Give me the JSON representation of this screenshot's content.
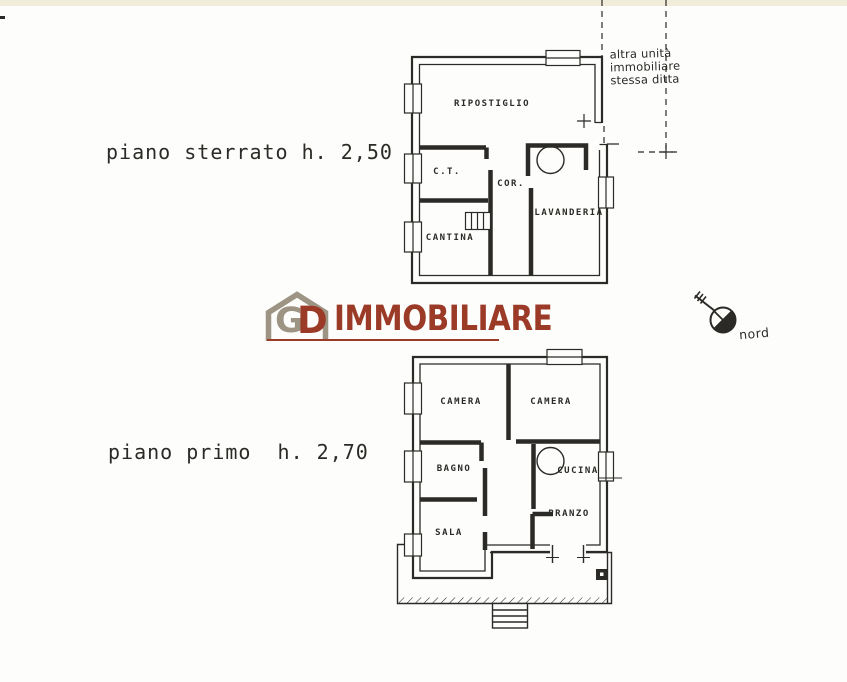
{
  "document": {
    "background": "#fdfdfc",
    "ink_color": "#2b2a26"
  },
  "floor_plans": {
    "basement": {
      "label": "piano sterrato h. 2,50",
      "rooms": [
        {
          "name": "RIPOSTIGLIO"
        },
        {
          "name": "C.T."
        },
        {
          "name": "COR."
        },
        {
          "name": "LAVANDERIA"
        },
        {
          "name": "CANTINA"
        }
      ]
    },
    "first_floor": {
      "label": "piano primo  h. 2,70",
      "rooms": [
        {
          "name": "CAMERA"
        },
        {
          "name": "CAMERA"
        },
        {
          "name": "BAGNO"
        },
        {
          "name": "CUCINA"
        },
        {
          "name": "SALA"
        },
        {
          "name": "PRANZO"
        }
      ]
    }
  },
  "annotation": {
    "lines": [
      "altra unità",
      "immobiliare",
      "stessa ditta"
    ]
  },
  "compass": {
    "label": "nord"
  },
  "watermark": {
    "monogram_g": "G",
    "monogram_d": "D",
    "brand": "IMMOBILIARE",
    "house_color": "#9d9484",
    "brand_color": "#9c3a28"
  }
}
